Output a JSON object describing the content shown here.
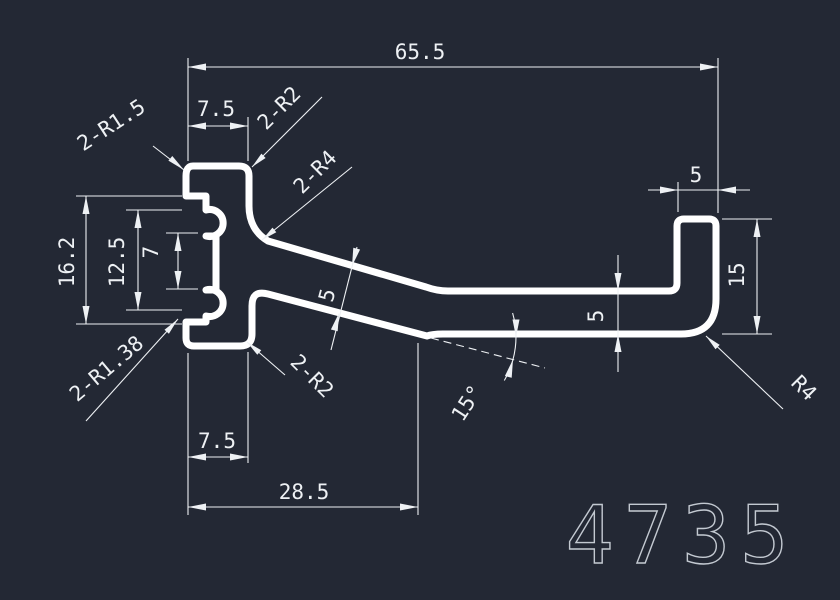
{
  "drawing": {
    "colors": {
      "background": "#232834",
      "profile_line": "#ffffff",
      "dimension_line": "#eef1f4",
      "part_number_stroke": "#c3c9d1"
    },
    "part_number": "4735",
    "dims": {
      "overall_width": "65.5",
      "head_top_width": "7.5",
      "head_height": "16.2",
      "lobe_span": "12.5",
      "lobe_gap": "7",
      "head_bottom_width": "7.5",
      "arm_offset": "28.5",
      "arm_slant_thickness": "5",
      "arm_flat_thickness": "5",
      "hook_width": "5",
      "hook_height": "15",
      "arm_angle": "15°"
    },
    "radii": {
      "top_left": "2-R1.5",
      "top_right": "2-R2",
      "arm_fillet": "2-R4",
      "bottom_left": "2-R1.38",
      "bottom_right": "2-R2",
      "hook_corner": "R4"
    }
  }
}
